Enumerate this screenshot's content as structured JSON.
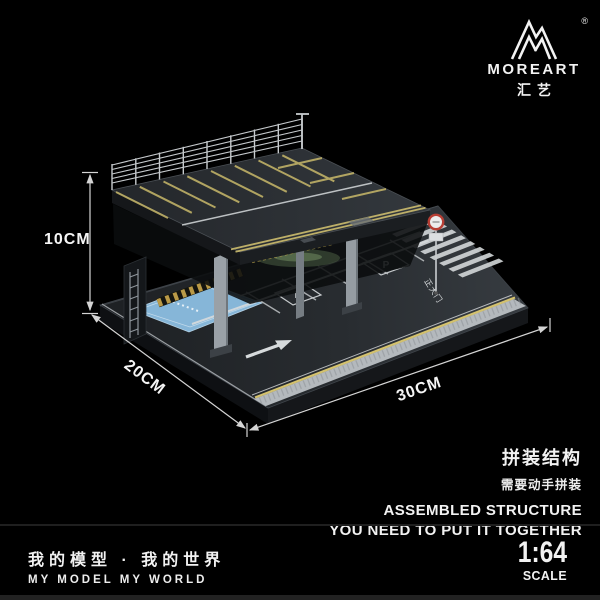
{
  "brand": {
    "name": "MOREART",
    "name_cn": "汇艺",
    "registered_mark": "®",
    "logo_icon": "mountain-m-logo"
  },
  "dimensions": {
    "height_label": "10CM",
    "depth_label": "20CM",
    "width_label": "30CM"
  },
  "diorama": {
    "parking_symbol": "P",
    "road_text": "正大门"
  },
  "assembly_note": {
    "title_cn": "拼装结构",
    "subtitle_cn": "需要动手拼装",
    "line1_en": "ASSEMBLED STRUCTURE",
    "line2_en": "YOU NEED TO PUT IT TOGETHER"
  },
  "footer": {
    "slogan_cn": "我的模型 · 我的世界",
    "slogan_en": "MY MODEL MY WORLD",
    "scale_value": "1:64",
    "scale_label": "SCALE"
  },
  "colors": {
    "background": "#000000",
    "text": "#f2f2f2",
    "asphalt_deck": "#2e3236",
    "asphalt_base": "#26292d",
    "marking_white": "#d6dadc",
    "marking_yellow": "#c9b96a",
    "fence_gray": "#c6cacd",
    "pillar_gray": "#9aa1a7",
    "blue_zone": "#86b6d8",
    "sign_ring_red": "#b73e34"
  }
}
